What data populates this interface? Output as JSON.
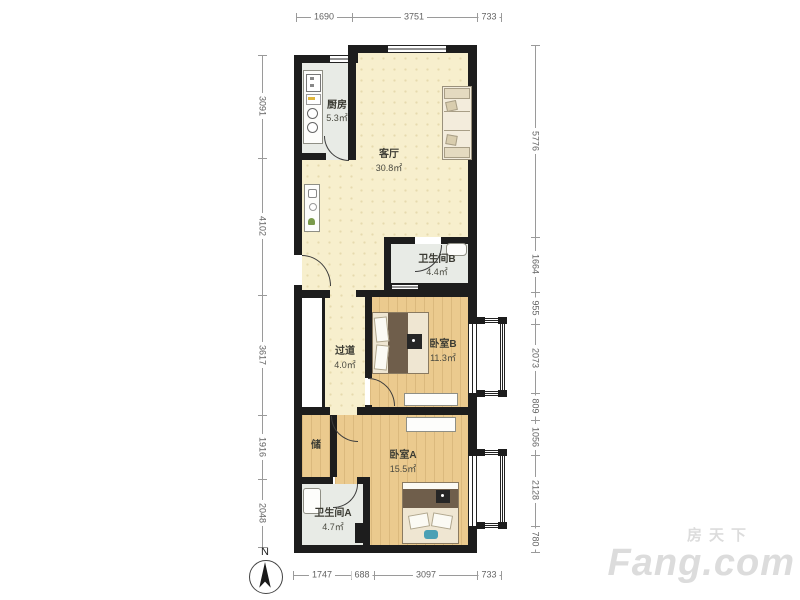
{
  "plan": {
    "title": "两室两卫户型图",
    "unit": "mm"
  },
  "rooms": {
    "kitchen": {
      "name": "厨房",
      "area": "5.3㎡"
    },
    "living": {
      "name": "客厅",
      "area": "30.8㎡"
    },
    "bath_b": {
      "name": "卫生间B",
      "area": "4.4㎡"
    },
    "hallway": {
      "name": "过道",
      "area": "4.0㎡"
    },
    "bedroom_b": {
      "name": "卧室B",
      "area": "11.3㎡"
    },
    "storage": {
      "name": "储",
      "area": ""
    },
    "bedroom_a": {
      "name": "卧室A",
      "area": "15.5㎡"
    },
    "bath_a": {
      "name": "卫生间A",
      "area": "4.7㎡"
    }
  },
  "dimensions": {
    "top": [
      "1690",
      "3751",
      "733"
    ],
    "bottom": [
      "1747",
      "688",
      "3097",
      "733"
    ],
    "left": [
      "3091",
      "4102",
      "3617",
      "1916",
      "2048"
    ],
    "right": [
      "5776",
      "1664",
      "955",
      "2073",
      "809",
      "1056",
      "2128",
      "780"
    ]
  },
  "compass": {
    "label": "N"
  },
  "watermark": {
    "cn": "房天下",
    "en": "Fang.com"
  },
  "colors": {
    "wall": "#1d1d1d",
    "floor_living": "#f7efcd",
    "floor_wood": "#ebca8e",
    "floor_tile": "#e8ebe6",
    "dimension_text": "#636363",
    "watermark": "#dcdcdc",
    "bed_blanket": "#6f5e4b",
    "accent_teal": "#4aa0b5"
  }
}
